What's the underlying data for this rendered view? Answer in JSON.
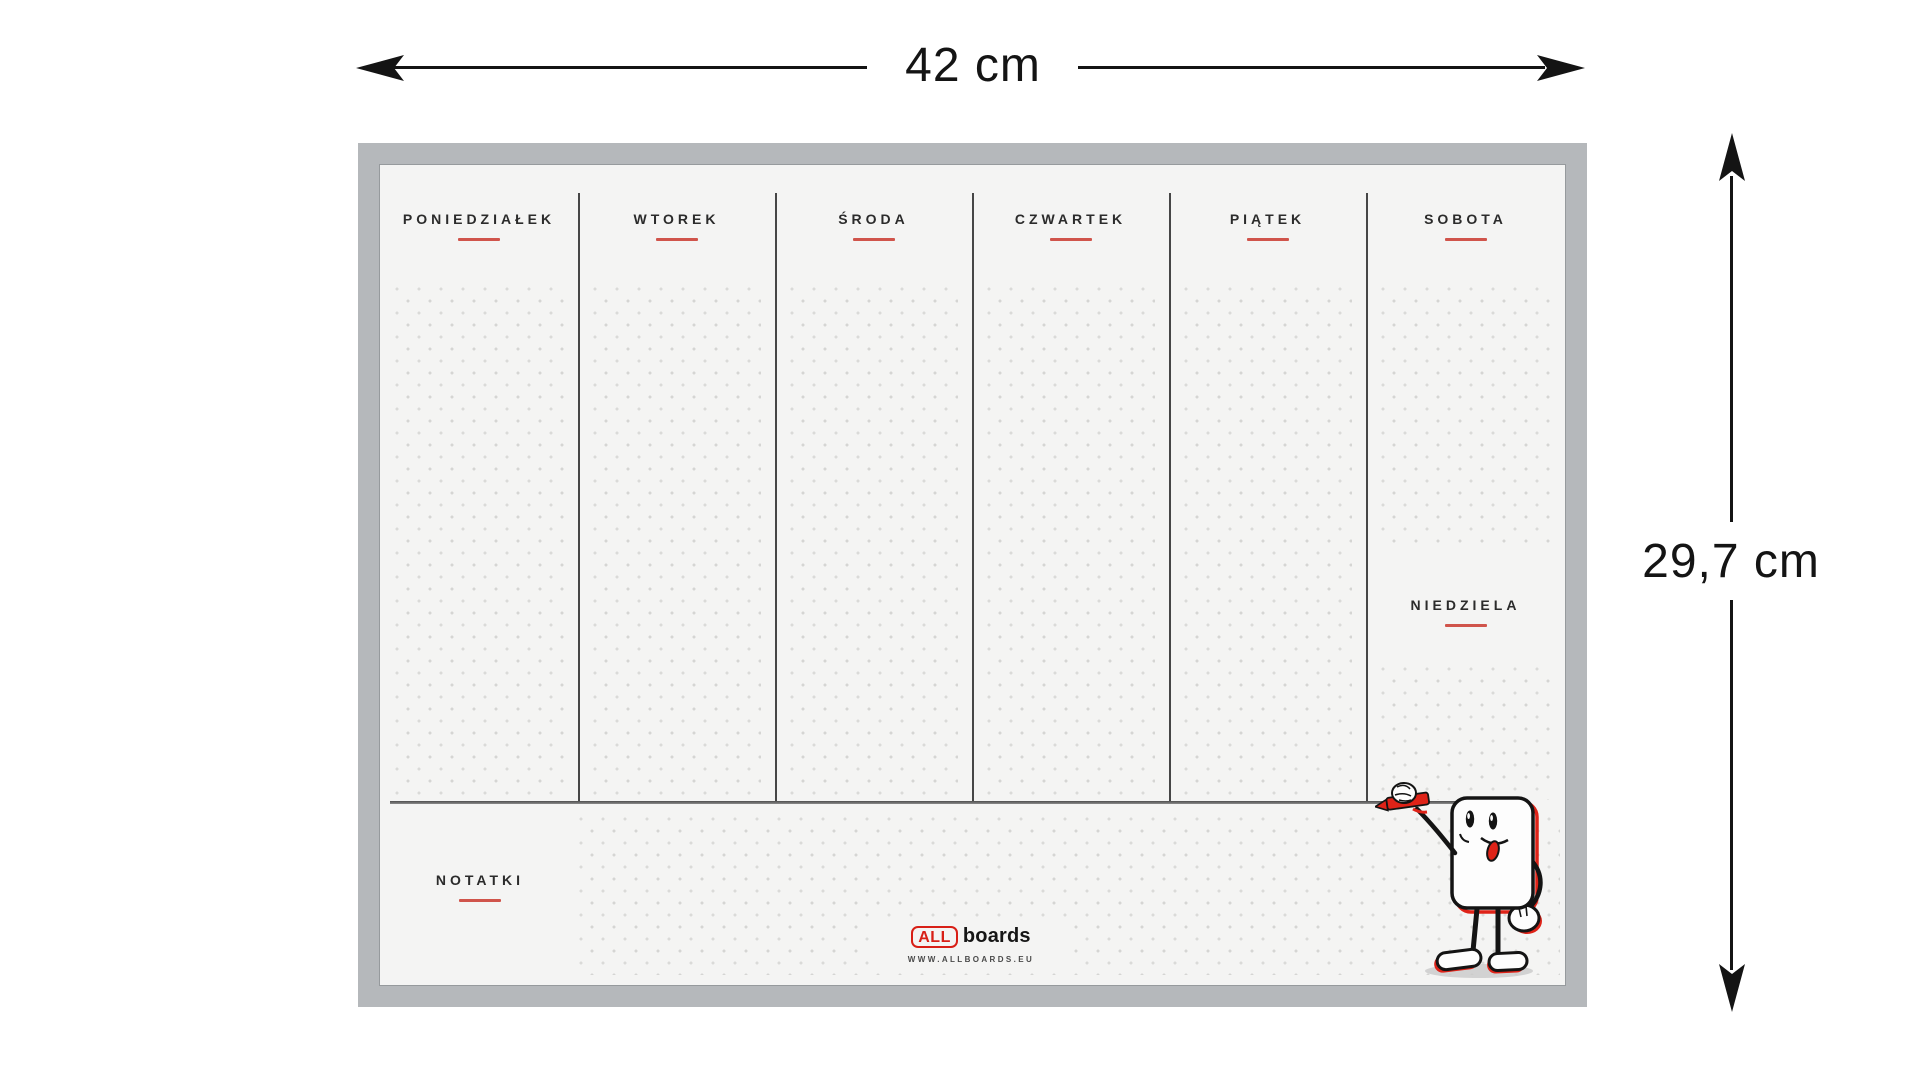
{
  "dimensions": {
    "width_label": "42 cm",
    "height_label": "29,7 cm"
  },
  "planner": {
    "days": [
      "PONIEDZIAŁEK",
      "WTOREK",
      "ŚRODA",
      "CZWARTEK",
      "PIĄTEK",
      "SOBOTA"
    ],
    "sunday": "NIEDZIELA",
    "notes": "NOTATKI",
    "logo_all": "ALL",
    "logo_boards": "boards",
    "website": "WWW.ALLBOARDS.EU"
  },
  "colors": {
    "accent_red": "#d0544b",
    "logo_red": "#d81f16",
    "frame": "#b5b8bb",
    "surface": "#f4f4f3",
    "separator": "#464646",
    "dimension": "#141414"
  }
}
